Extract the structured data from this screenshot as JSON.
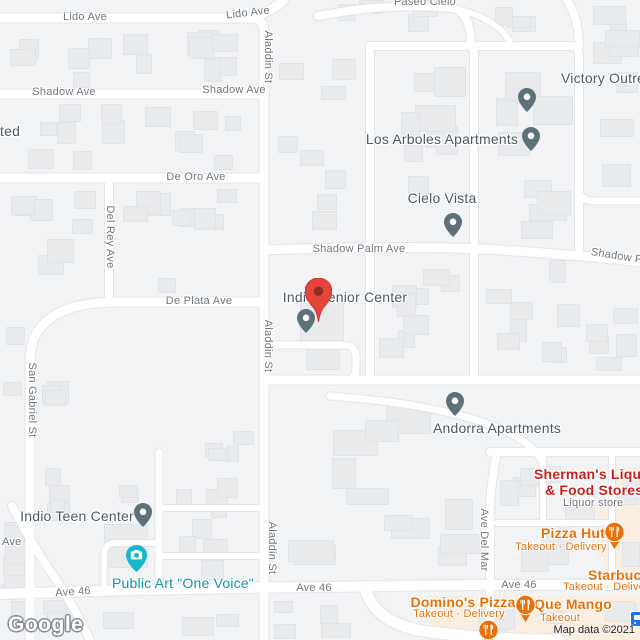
{
  "map": {
    "logo_text": "Google",
    "attribution": "Map data ©2021",
    "street_labels": [
      {
        "text": "Lido Ave",
        "x": 85,
        "y": 17
      },
      {
        "text": "Lido Ave",
        "x": 248,
        "y": 13,
        "rotate": -7
      },
      {
        "text": "Shadow Ave",
        "x": 64,
        "y": 92
      },
      {
        "text": "Shadow Ave",
        "x": 234,
        "y": 90
      },
      {
        "text": "Aladdin St",
        "x": 268,
        "y": 57,
        "rotate": 90
      },
      {
        "text": "Paseo Cielo",
        "x": 425,
        "y": 2
      },
      {
        "text": "De Oro Ave",
        "x": 196,
        "y": 177
      },
      {
        "text": "Del Rey Ave",
        "x": 110,
        "y": 237,
        "rotate": 90
      },
      {
        "text": "Shadow Palm Ave",
        "x": 359,
        "y": 249
      },
      {
        "text": "Shadow Pa",
        "x": 591,
        "y": 252,
        "rotate": 9,
        "anchor": "left"
      },
      {
        "text": "De Plata Ave",
        "x": 199,
        "y": 301
      },
      {
        "text": "Aladdin St",
        "x": 268,
        "y": 346,
        "rotate": 90
      },
      {
        "text": "San Gabriel St",
        "x": 32,
        "y": 400,
        "rotate": 90
      },
      {
        "text": "Ave Del Mar",
        "x": 484,
        "y": 540,
        "rotate": 90
      },
      {
        "text": "Aladdin St",
        "x": 272,
        "y": 548,
        "rotate": 90
      },
      {
        "text": "Ave",
        "x": 2,
        "y": 542,
        "anchor": "left"
      },
      {
        "text": "Ave 46",
        "x": 73,
        "y": 592,
        "rotate": -4
      },
      {
        "text": "Ave 46",
        "x": 314,
        "y": 588
      },
      {
        "text": "Ave 46",
        "x": 519,
        "y": 585
      }
    ],
    "poi_labels": [
      {
        "text": "ted",
        "x": 0,
        "y": 131,
        "anchor": "left"
      },
      {
        "text": "Victory Outre",
        "x": 561,
        "y": 78,
        "anchor": "left"
      },
      {
        "text": "Los Arboles Apartments",
        "x": 442,
        "y": 139
      },
      {
        "text": "Cielo Vista",
        "x": 442,
        "y": 198
      },
      {
        "text": "Indio Senior Center",
        "x": 345,
        "y": 297
      },
      {
        "text": "Andorra Apartments",
        "x": 497,
        "y": 428
      },
      {
        "text": "Indio Teen Center",
        "x": 77,
        "y": 516
      },
      {
        "text": "Public Art \"One Voice\"",
        "x": 183,
        "y": 583,
        "color": "teal"
      }
    ],
    "business_labels": [
      {
        "text": "Sherman's Liquor",
        "x": 534,
        "y": 474,
        "color": "red",
        "anchor": "left"
      },
      {
        "text": "& Food Stores",
        "x": 545,
        "y": 490,
        "color": "red",
        "anchor": "left"
      },
      {
        "text": "Liquor store",
        "x": 563,
        "y": 503,
        "color": "gray",
        "anchor": "left",
        "sub": true
      },
      {
        "text": "Pizza Hut",
        "x": 573,
        "y": 533,
        "color": "orange"
      },
      {
        "text": "Takeout · Delivery",
        "x": 561,
        "y": 547,
        "color": "orange",
        "sub": true
      },
      {
        "text": "Starbuck",
        "x": 588,
        "y": 575,
        "color": "orange",
        "anchor": "left"
      },
      {
        "text": "Takeout · Deliver",
        "x": 563,
        "y": 587,
        "color": "orange",
        "anchor": "left",
        "sub": true
      },
      {
        "text": "Domino's Pizza",
        "x": 463,
        "y": 602,
        "color": "orange"
      },
      {
        "text": "Takeout · Delivery",
        "x": 459,
        "y": 614,
        "color": "orange",
        "sub": true
      },
      {
        "text": "Que Mango",
        "x": 573,
        "y": 604,
        "color": "orange"
      },
      {
        "text": "Takeout",
        "x": 560,
        "y": 618,
        "color": "orange",
        "sub": true
      }
    ],
    "markers": [
      {
        "type": "gray",
        "name": "victory-outreach",
        "x": 527,
        "y": 112
      },
      {
        "type": "gray",
        "name": "los-arboles-apartments",
        "x": 531,
        "y": 151
      },
      {
        "type": "gray",
        "name": "cielo-vista",
        "x": 453,
        "y": 237
      },
      {
        "type": "gray",
        "name": "indio-senior-center-poi",
        "x": 306,
        "y": 333
      },
      {
        "type": "gray",
        "name": "andorra-apartments",
        "x": 455,
        "y": 416
      },
      {
        "type": "gray",
        "name": "indio-teen-center",
        "x": 143,
        "y": 527
      },
      {
        "type": "teal-camera",
        "name": "public-art-one-voice",
        "x": 136,
        "y": 572
      },
      {
        "type": "orange-food",
        "name": "pizza-hut",
        "x": 614,
        "y": 549
      },
      {
        "type": "orange-food",
        "name": "que-mango",
        "x": 525,
        "y": 622
      },
      {
        "type": "orange-food",
        "name": "dominos-pizza",
        "x": 488,
        "y": 647
      },
      {
        "type": "red",
        "name": "indio-senior-center",
        "x": 318,
        "y": 322
      }
    ],
    "colors": {
      "land": "#f2f3f5",
      "building": "#e8eaec",
      "building_border": "#dfe2e6",
      "road_fill": "#ffffff",
      "road_casing": "#e2e4e8",
      "commercial_area": "#faeee0",
      "street_label": "#72777c",
      "poi_label": "#4d5a63",
      "teal_label": "#0d98a6",
      "teal_pin": "#16b8cc",
      "orange_label": "#e8710a",
      "red_label": "#c5221f",
      "gray_pin": "#5e7078",
      "red_pin": "#e8453a",
      "red_pin_center": "#8e2d23",
      "blue_icon": "#1a73e8",
      "attribution_text": "#222222"
    }
  }
}
